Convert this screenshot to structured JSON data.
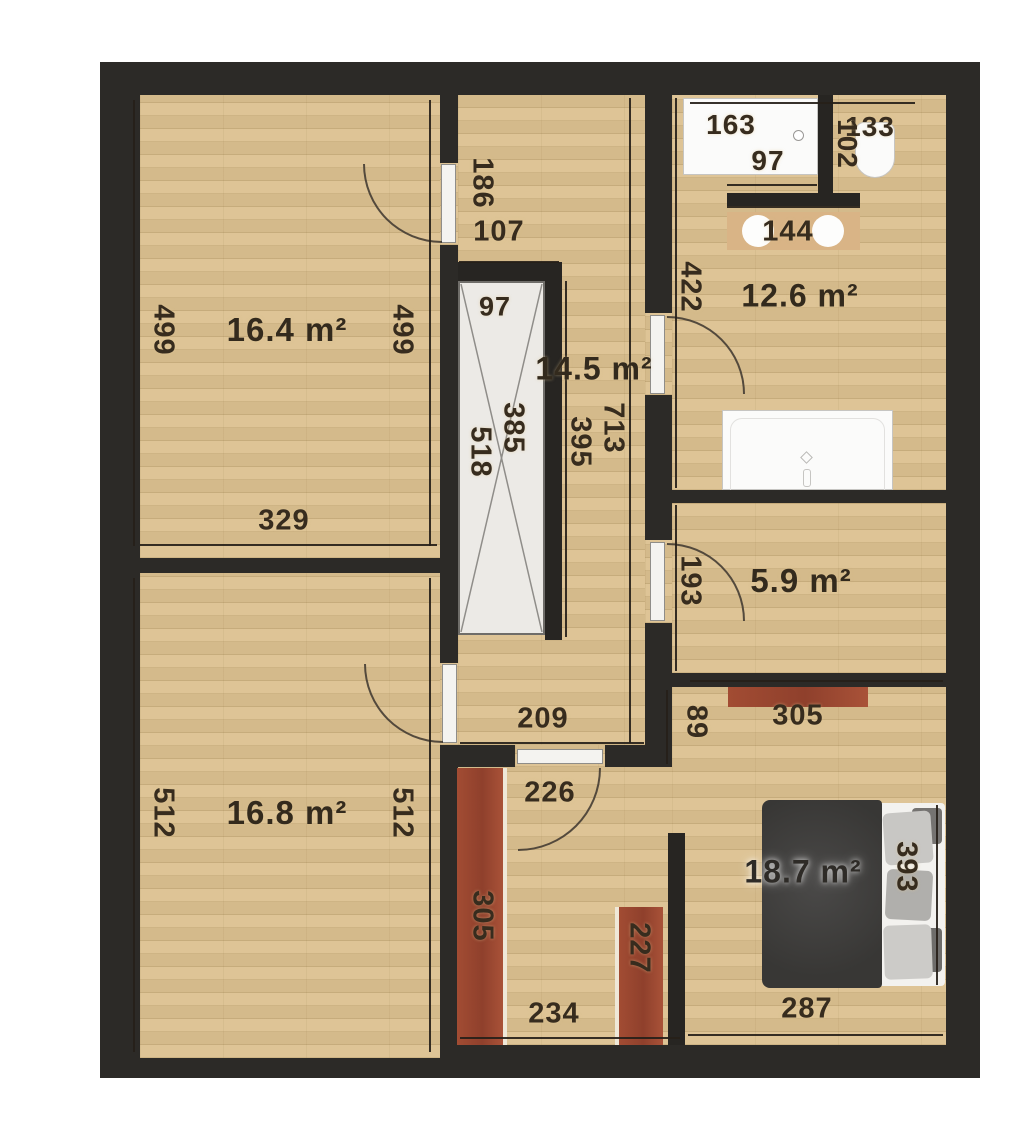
{
  "plan": {
    "rooms": [
      {
        "id": "room-16-4",
        "area_label": "16.4 m²"
      },
      {
        "id": "hall-14-5",
        "area_label": "14.5 m²"
      },
      {
        "id": "bath-12-6",
        "area_label": "12.6 m²"
      },
      {
        "id": "room-5-9",
        "area_label": "5.9 m²"
      },
      {
        "id": "room-16-8",
        "area_label": "16.8 m²"
      },
      {
        "id": "bedroom-18-7",
        "area_label": "18.7 m²"
      }
    ],
    "dimensions": {
      "d499l": "499",
      "d499r": "499",
      "d329": "329",
      "d186": "186",
      "d107": "107",
      "d97w": "97",
      "d518": "518",
      "d385": "385",
      "d395": "395",
      "d713": "713",
      "d163": "163",
      "d97s": "97",
      "d133": "133",
      "d102": "102",
      "d144": "144",
      "d422": "422",
      "d193": "193",
      "d89": "89",
      "d305bed": "305",
      "d209": "209",
      "d512l": "512",
      "d512r": "512",
      "d226": "226",
      "d305corr": "305",
      "d227": "227",
      "d234": "234",
      "d287": "287",
      "d393": "393"
    },
    "colors": {
      "wall": "#2c2a27",
      "floor": "#dcc190",
      "furniture_red": "#9e4a31",
      "fixture_white": "#fbfbfa",
      "bed_blanket": "#3e3d3c"
    }
  }
}
